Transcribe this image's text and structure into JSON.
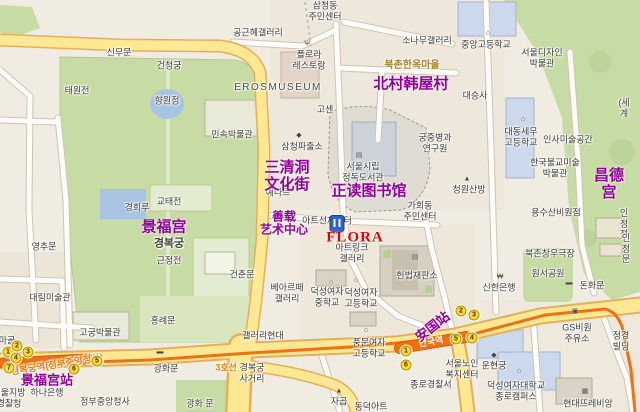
{
  "meta": {
    "description": "Tourist map of the Gyeongbokgung / Bukchon / Anguk area of Seoul (Korean base map with purple Chinese annotations)"
  },
  "colors": {
    "annotation_purple": "#91009b",
    "annotation_red": "#e80000",
    "subway_line_orange": "#ef7113",
    "subway_text_orange": "#f07b00",
    "road_yellow": "#ffe894",
    "park_green": "#c7dba4",
    "pond_blue": "#a9c3e2",
    "exit_badge_yellow": "#ffd83d",
    "korean_label_gray": "#3d3c36",
    "village_label_brown": "#a87f2c"
  },
  "chinese_annotations": [
    {
      "t": "三清洞\n文化街",
      "x": 287,
      "y": 177,
      "n": "annotation-samcheongdong-culture-street"
    },
    {
      "t": "正读图书馆",
      "x": 369,
      "y": 192,
      "n": "annotation-jeongdok-library"
    },
    {
      "t": "北村韩屋村",
      "x": 411,
      "y": 85,
      "n": "annotation-bukchon-hanok-village"
    },
    {
      "t": "昌德宫",
      "x": 609,
      "y": 185,
      "n": "annotation-changdeokgung"
    },
    {
      "t": "景福宫",
      "x": 164,
      "y": 228,
      "n": "annotation-gyeongbokgung"
    },
    {
      "t": "善载\n艺术中心",
      "x": 284,
      "y": 224,
      "c": "zh-sm",
      "n": "annotation-artsonje-center"
    },
    {
      "t": "安国站",
      "x": 433,
      "y": 327,
      "r": -38,
      "c": "zh-md",
      "n": "annotation-anguk-station"
    },
    {
      "t": "景福宫站",
      "x": 47,
      "y": 381,
      "c": "zh-md",
      "n": "annotation-gyeongbokgung-station"
    }
  ],
  "flora": {
    "label": "FLORA",
    "x": 355,
    "y": 238,
    "pin_x": 337,
    "pin_y": 232
  },
  "korean_labels": [
    {
      "t": "삼청동\n주민센터",
      "x": 325,
      "y": 11
    },
    {
      "t": "공근혜갤러리",
      "x": 258,
      "y": 33
    },
    {
      "t": "플로라\n레스토랑",
      "x": 309,
      "y": 60
    },
    {
      "t": "EROSMUSEUM",
      "x": 278,
      "y": 88,
      "c": "caps"
    },
    {
      "t": "신무문",
      "x": 119,
      "y": 53
    },
    {
      "t": "건청궁",
      "x": 169,
      "y": 66
    },
    {
      "t": "태원전",
      "x": 77,
      "y": 91
    },
    {
      "t": "향원정",
      "x": 167,
      "y": 101
    },
    {
      "t": "민속박물관",
      "x": 232,
      "y": 135
    },
    {
      "t": "삼청파출소",
      "x": 302,
      "y": 147
    },
    {
      "t": "예나르",
      "x": 278,
      "y": 193
    },
    {
      "t": "교태전",
      "x": 169,
      "y": 202
    },
    {
      "t": "고센",
      "x": 325,
      "y": 110
    },
    {
      "t": "서울시립\n정독도서관",
      "x": 363,
      "y": 172
    },
    {
      "t": "궁중병과\n연구원",
      "x": 435,
      "y": 143
    },
    {
      "t": "소나무갤러리",
      "x": 427,
      "y": 41
    },
    {
      "t": "북촌한옥마을",
      "x": 412,
      "y": 66,
      "c": "brown"
    },
    {
      "t": "중앙고등학교",
      "x": 486,
      "y": 45
    },
    {
      "t": "서울디자인\n박물관",
      "x": 542,
      "y": 58
    },
    {
      "t": "대승사",
      "x": 475,
      "y": 96
    },
    {
      "t": "대동세무\n고등학교",
      "x": 521,
      "y": 137
    },
    {
      "t": "인사미술공간",
      "x": 568,
      "y": 140
    },
    {
      "t": "한국불교미술\n박물관",
      "x": 555,
      "y": 168
    },
    {
      "t": "청원산방",
      "x": 469,
      "y": 190
    },
    {
      "t": "(세계",
      "x": 624,
      "y": 108
    },
    {
      "t": "가회동\n주민센터",
      "x": 420,
      "y": 211
    },
    {
      "t": "아트선재센터",
      "x": 327,
      "y": 221
    },
    {
      "t": "아트링크\n갤러리",
      "x": 352,
      "y": 253
    },
    {
      "t": "헌법재판소",
      "x": 417,
      "y": 276
    },
    {
      "t": "베아르떼\n갤러리",
      "x": 287,
      "y": 293
    },
    {
      "t": "덕성여자\n중학교",
      "x": 327,
      "y": 297
    },
    {
      "t": "덕성여자\n고등학교",
      "x": 361,
      "y": 298
    },
    {
      "t": "갤러리현대",
      "x": 263,
      "y": 336
    },
    {
      "t": "풍문여자\n고등학교",
      "x": 369,
      "y": 348
    },
    {
      "t": "서울노인\n복지센터",
      "x": 462,
      "y": 369
    },
    {
      "t": "운현궁",
      "x": 494,
      "y": 366
    },
    {
      "t": "종로경찰서",
      "x": 431,
      "y": 385
    },
    {
      "t": "덕성여자대학교\n종로캠퍼스",
      "x": 516,
      "y": 391
    },
    {
      "t": "현대뜨레비앙",
      "x": 588,
      "y": 404
    },
    {
      "t": "동덕아트",
      "x": 371,
      "y": 407
    },
    {
      "t": "자곱",
      "x": 339,
      "y": 402
    },
    {
      "t": "신한은행",
      "x": 499,
      "y": 288
    },
    {
      "t": "북촌창우극장",
      "x": 550,
      "y": 254
    },
    {
      "t": "원서공원",
      "x": 548,
      "y": 274
    },
    {
      "t": "돈화문",
      "x": 592,
      "y": 286
    },
    {
      "t": "용수산비원점",
      "x": 556,
      "y": 213
    },
    {
      "t": "인정전",
      "x": 624,
      "y": 224
    },
    {
      "t": "인정문",
      "x": 626,
      "y": 249
    },
    {
      "t": "GS비원\n주유소",
      "x": 577,
      "y": 333
    },
    {
      "t": "정경빌딩",
      "x": 621,
      "y": 341
    },
    {
      "t": "경복궁",
      "x": 169,
      "y": 244,
      "c": "palace"
    },
    {
      "t": "근정전",
      "x": 169,
      "y": 261
    },
    {
      "t": "경회루",
      "x": 137,
      "y": 208
    },
    {
      "t": "영추문",
      "x": 44,
      "y": 247
    },
    {
      "t": "대림미술관",
      "x": 50,
      "y": 298
    },
    {
      "t": "건춘문",
      "x": 242,
      "y": 275
    },
    {
      "t": "홍례문",
      "x": 163,
      "y": 321
    },
    {
      "t": "고궁박물관",
      "x": 100,
      "y": 333
    },
    {
      "t": "하나은행",
      "x": 47,
      "y": 393
    },
    {
      "t": "정부중앙청사",
      "x": 105,
      "y": 402
    },
    {
      "t": "광화 문",
      "x": 200,
      "y": 404
    },
    {
      "t": "광화문",
      "x": 166,
      "y": 369
    },
    {
      "t": "경복궁\n사거리",
      "x": 252,
      "y": 373
    },
    {
      "t": "서울지방\n경찰청",
      "x": 9,
      "y": 398
    },
    {
      "t": "마골",
      "x": 7,
      "y": 341
    }
  ],
  "subway": {
    "line3_label": {
      "t": "3호선",
      "x": 226,
      "y": 368
    },
    "gyeongbokgung_station_label": {
      "t": "경복궁역(정부중앙청사)",
      "x": 57,
      "y": 365,
      "r": -9
    },
    "anguk_station_label": {
      "t": "안국역",
      "x": 431,
      "y": 342,
      "r": -10
    },
    "gyeongbokgung_exits": [
      {
        "n": "1",
        "x": 8,
        "y": 352
      },
      {
        "n": "2",
        "x": 17,
        "y": 346
      },
      {
        "n": "3",
        "x": 28,
        "y": 352
      },
      {
        "n": "4",
        "x": 16,
        "y": 358
      },
      {
        "n": "5",
        "x": 97,
        "y": 361
      },
      {
        "n": "6",
        "x": 74,
        "y": 369
      },
      {
        "n": "7",
        "x": 9,
        "y": 368
      }
    ],
    "anguk_exits": [
      {
        "n": "1",
        "x": 406,
        "y": 351
      },
      {
        "n": "2",
        "x": 461,
        "y": 311
      },
      {
        "n": "3",
        "x": 474,
        "y": 315
      },
      {
        "n": "4",
        "x": 472,
        "y": 338
      },
      {
        "n": "5",
        "x": 456,
        "y": 339
      },
      {
        "n": "6",
        "x": 406,
        "y": 365
      }
    ]
  },
  "icons": [
    {
      "g": "Ψ",
      "x": 307,
      "y": 44,
      "n": "restaurant-icon"
    },
    {
      "g": "◆",
      "x": 299,
      "y": 135,
      "n": "police-station-icon"
    },
    {
      "g": "▤",
      "x": 359,
      "y": 155,
      "n": "library-icon"
    },
    {
      "g": "⌂",
      "x": 488,
      "y": 33,
      "n": "school-icon"
    },
    {
      "g": "⌂",
      "x": 523,
      "y": 119,
      "n": "school-icon"
    },
    {
      "g": "⌂",
      "x": 331,
      "y": 282,
      "n": "school-icon"
    },
    {
      "g": "⌂",
      "x": 356,
      "y": 280,
      "n": "school-icon"
    },
    {
      "g": "⌂",
      "x": 366,
      "y": 330,
      "n": "school-icon"
    },
    {
      "g": "⌂",
      "x": 519,
      "y": 371,
      "n": "school-icon"
    },
    {
      "g": "◆",
      "x": 494,
      "y": 355,
      "n": "palace-icon"
    },
    {
      "g": "₩",
      "x": 500,
      "y": 277,
      "n": "bank-icon"
    },
    {
      "g": "▣",
      "x": 575,
      "y": 311,
      "n": "gas-station-icon"
    },
    {
      "g": "▤",
      "x": 415,
      "y": 257,
      "n": "court-icon"
    },
    {
      "g": "▦",
      "x": 585,
      "y": 391,
      "n": "building-icon"
    },
    {
      "g": "▲",
      "x": 339,
      "y": 391,
      "n": "monument-icon"
    },
    {
      "g": "▬",
      "x": 160,
      "y": 352,
      "n": "gate-icon"
    },
    {
      "g": "▲",
      "x": 467,
      "y": 179,
      "n": "poi-icon"
    },
    {
      "g": "▬",
      "x": 569,
      "y": 283,
      "n": "gate-icon"
    }
  ]
}
